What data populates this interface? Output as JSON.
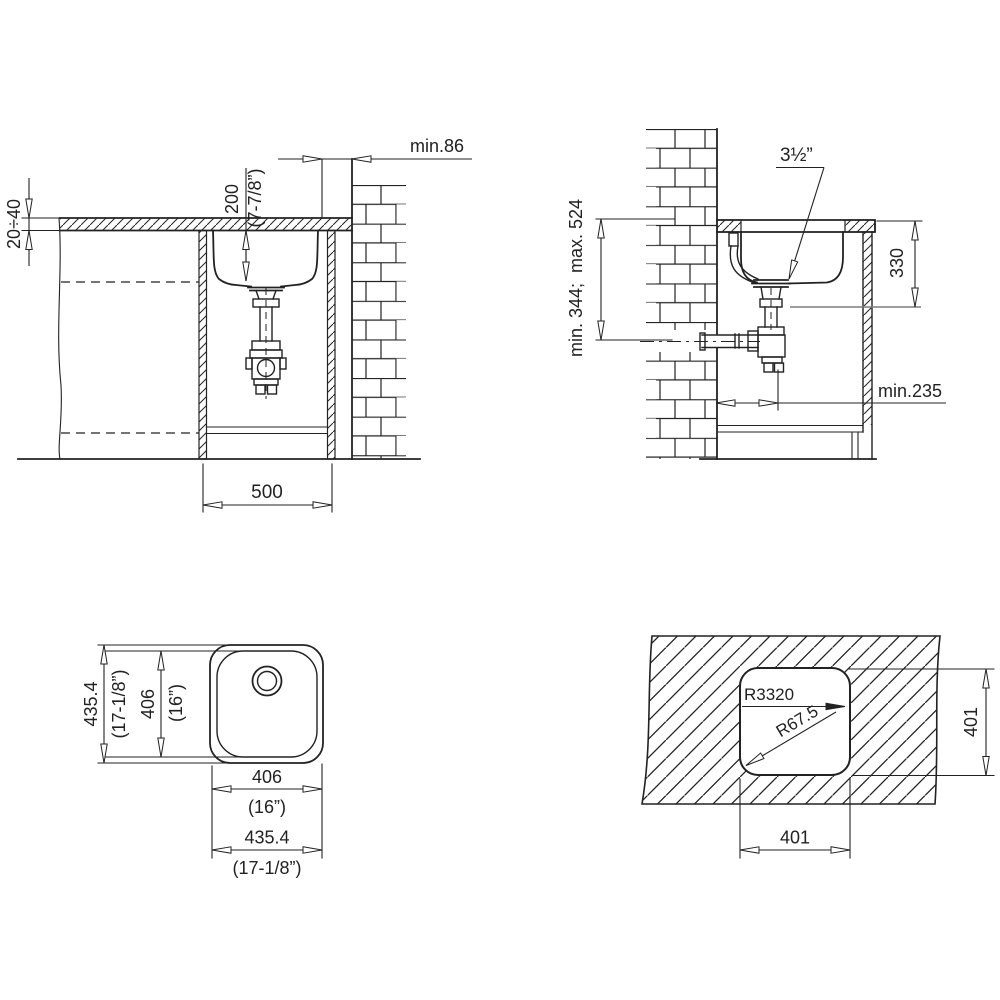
{
  "page": {
    "background": "#ffffff",
    "line_color": "#222222"
  },
  "views": {
    "side_section": {
      "min_wall_clearance": "min.86",
      "bowl_depth_mm": "200",
      "bowl_depth_in": "(7-7/8”)",
      "countertop_thickness": "20÷40",
      "cabinet_width": "500"
    },
    "front_section": {
      "waste_size": "3½”",
      "outlet_height_range": "min. 344;  max. 524",
      "rim_to_outlet_height": "330",
      "wall_to_drain_min": "min.235"
    },
    "plan_view": {
      "outer_width_mm": "435.4",
      "outer_width_in": "(17-1/8”)",
      "bowl_width_mm": "406",
      "bowl_width_in": "(16”)",
      "outer_height_mm": "435.4",
      "outer_height_in": "(17-1/8”)",
      "bowl_height_mm": "406",
      "bowl_height_in": "(16”)"
    },
    "cutout_template": {
      "edge_radius": "R3320",
      "corner_radius": "R67.5",
      "cutout_width": "401",
      "cutout_height": "401"
    }
  }
}
